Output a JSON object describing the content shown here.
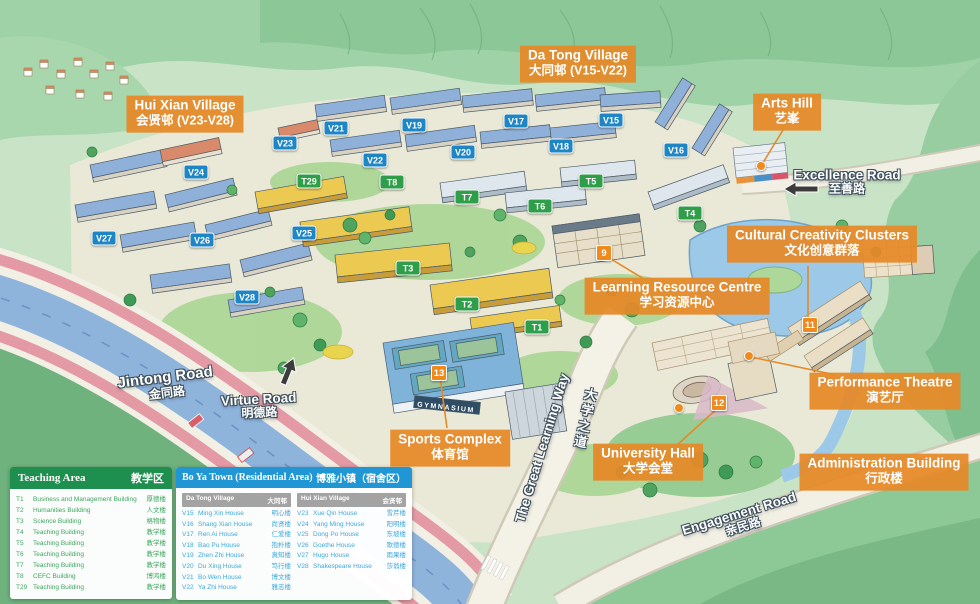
{
  "colors": {
    "label_orange": "#e68927",
    "marker_blue": "#1f86c5",
    "marker_green": "#2f9e49",
    "marker_orange": "#f08a1c",
    "teaching_header": "#1e8f4e",
    "teaching_text": "#3fa45f",
    "boya_header": "#2097d4",
    "boya_text": "#3fa8dc",
    "subheader_gray": "#a3a3a3",
    "connector": "#e68927"
  },
  "map": {
    "area_labels": [
      {
        "id": "hui-xian-village",
        "en": "Hui Xian Village",
        "cn": "会贤邨 (V23-V28)",
        "x": 185,
        "y": 114
      },
      {
        "id": "da-tong-village",
        "en": "Da Tong Village",
        "cn": "大同邨 (V15-V22)",
        "x": 578,
        "y": 64
      },
      {
        "id": "arts-hill",
        "en": "Arts Hill",
        "cn": "艺峯",
        "x": 787,
        "y": 112
      },
      {
        "id": "cultural-creativity-clusters",
        "en": "Cultural Creativity Clusters",
        "cn": "文化创意群落",
        "x": 822,
        "y": 244
      },
      {
        "id": "learning-resource-centre",
        "en": "Learning Resource Centre",
        "cn": "学习资源中心",
        "x": 677,
        "y": 296
      },
      {
        "id": "performance-theatre",
        "en": "Performance Theatre",
        "cn": "演艺厅",
        "x": 885,
        "y": 391
      },
      {
        "id": "administration-building",
        "en": "Administration Building",
        "cn": "行政楼",
        "x": 884,
        "y": 472
      },
      {
        "id": "sports-complex",
        "en": "Sports Complex",
        "cn": "体育馆",
        "x": 450,
        "y": 448
      },
      {
        "id": "university-hall",
        "en": "University Hall",
        "cn": "大学会堂",
        "x": 648,
        "y": 462
      }
    ],
    "road_labels": [
      {
        "id": "excellence-road",
        "en": "Excellence Road",
        "cn": "至善路",
        "x": 847,
        "y": 182,
        "rot": 0,
        "big": false
      },
      {
        "id": "jintong-road",
        "en": "Jintong Road",
        "cn": "金同路",
        "x": 166,
        "y": 385,
        "rot": -7,
        "big": true
      },
      {
        "id": "virtue-road",
        "en": "Virtue Road",
        "cn": "明德路",
        "x": 259,
        "y": 406,
        "rot": -3,
        "big": false
      },
      {
        "id": "engagement-road",
        "en": "Engagement Road",
        "cn": "亲民路",
        "x": 741,
        "y": 520,
        "rot": -17,
        "big": false
      },
      {
        "id": "great-learning-way",
        "en": "The Great Learning Way",
        "cn": "大学之道",
        "x": 542,
        "y": 448,
        "rot": -73,
        "big": false,
        "cn_x": 575,
        "cn_y": 442,
        "cn_rot": 12
      }
    ],
    "markers": [
      {
        "label": "V21",
        "type": "blue",
        "x": 336,
        "y": 128
      },
      {
        "label": "V19",
        "type": "blue",
        "x": 414,
        "y": 125
      },
      {
        "label": "V17",
        "type": "blue",
        "x": 516,
        "y": 121
      },
      {
        "label": "V15",
        "type": "blue",
        "x": 611,
        "y": 120
      },
      {
        "label": "V18",
        "type": "blue",
        "x": 561,
        "y": 146
      },
      {
        "label": "V16",
        "type": "blue",
        "x": 676,
        "y": 150
      },
      {
        "label": "V22",
        "type": "blue",
        "x": 375,
        "y": 160
      },
      {
        "label": "V20",
        "type": "blue",
        "x": 463,
        "y": 152
      },
      {
        "label": "V23",
        "type": "blue",
        "x": 285,
        "y": 143
      },
      {
        "label": "V24",
        "type": "blue",
        "x": 196,
        "y": 172
      },
      {
        "label": "V25",
        "type": "blue",
        "x": 304,
        "y": 233
      },
      {
        "label": "V26",
        "type": "blue",
        "x": 202,
        "y": 240
      },
      {
        "label": "V27",
        "type": "blue",
        "x": 104,
        "y": 238
      },
      {
        "label": "V28",
        "type": "blue",
        "x": 247,
        "y": 297
      },
      {
        "label": "T29",
        "type": "green",
        "x": 309,
        "y": 181
      },
      {
        "label": "T8",
        "type": "green",
        "x": 392,
        "y": 182
      },
      {
        "label": "T7",
        "type": "green",
        "x": 467,
        "y": 197
      },
      {
        "label": "T6",
        "type": "green",
        "x": 540,
        "y": 206
      },
      {
        "label": "T5",
        "type": "green",
        "x": 591,
        "y": 181
      },
      {
        "label": "T4",
        "type": "green",
        "x": 690,
        "y": 213
      },
      {
        "label": "T3",
        "type": "green",
        "x": 408,
        "y": 268
      },
      {
        "label": "T2",
        "type": "green",
        "x": 467,
        "y": 304
      },
      {
        "label": "T1",
        "type": "green",
        "x": 537,
        "y": 327
      },
      {
        "label": "9",
        "type": "orange",
        "x": 604,
        "y": 253
      },
      {
        "label": "11",
        "type": "orange",
        "x": 810,
        "y": 325
      },
      {
        "label": "12",
        "type": "orange",
        "x": 719,
        "y": 403
      },
      {
        "label": "13",
        "type": "orange",
        "x": 439,
        "y": 373
      },
      {
        "label": "",
        "type": "dot",
        "x": 761,
        "y": 166
      },
      {
        "label": "",
        "type": "dot",
        "x": 749,
        "y": 356
      },
      {
        "label": "",
        "type": "dot",
        "x": 679,
        "y": 408
      }
    ],
    "connectors": [
      [
        761,
        166,
        783,
        130
      ],
      [
        606,
        256,
        644,
        279
      ],
      [
        808,
        266,
        808,
        317
      ],
      [
        751,
        357,
        836,
        375
      ],
      [
        719,
        407,
        676,
        446
      ],
      [
        440,
        377,
        447,
        428
      ]
    ],
    "building_texts": [
      {
        "id": "gymnasium",
        "text": "GYMNASIUM",
        "x": 446,
        "y": 408,
        "rot": 6
      }
    ]
  },
  "legend_teaching": {
    "title_en": "Teaching Area",
    "title_cn": "教学区",
    "rows": [
      [
        "T1",
        "Business and Management Building",
        "厚德楼"
      ],
      [
        "T2",
        "Humanities Building",
        "人文楼"
      ],
      [
        "T3",
        "Science Building",
        "格物楼"
      ],
      [
        "T4",
        "Teaching Building",
        "教学楼"
      ],
      [
        "T5",
        "Teaching Building",
        "教学楼"
      ],
      [
        "T6",
        "Teaching Building",
        "教学楼"
      ],
      [
        "T7",
        "Teaching Building",
        "教学楼"
      ],
      [
        "T8",
        "CEFC Building",
        "博鸿楼"
      ],
      [
        "T29",
        "Teaching Building",
        "教学楼"
      ]
    ]
  },
  "legend_boya": {
    "title_en": "Bo Ya Town (Residential Area)",
    "title_cn": "博雅小镇（宿舍区）",
    "columns": [
      {
        "header_en": "Da Tong Village",
        "header_cn": "大同邨",
        "rows": [
          [
            "V15",
            "Ming Xin House",
            "明心楼"
          ],
          [
            "V16",
            "Shang Xian House",
            "尚贤楼"
          ],
          [
            "V17",
            "Ren Ai House",
            "仁爱楼"
          ],
          [
            "V18",
            "Bao Pu House",
            "抱朴楼"
          ],
          [
            "V19",
            "Zhen Zhi House",
            "真知楼"
          ],
          [
            "V20",
            "Du Xing House",
            "笃行楼"
          ],
          [
            "V21",
            "Bo Wen House",
            "博文楼"
          ],
          [
            "V22",
            "Ya Zhi House",
            "雅志楼"
          ]
        ]
      },
      {
        "header_en": "Hui Xian Village",
        "header_cn": "会贤邨",
        "rows": [
          [
            "V23",
            "Xue Qin House",
            "雪芹楼"
          ],
          [
            "V24",
            "Yang Ming House",
            "阳明楼"
          ],
          [
            "V25",
            "Dong Po House",
            "东坡楼"
          ],
          [
            "V26",
            "Goethe House",
            "歌德楼"
          ],
          [
            "V27",
            "Hugo House",
            "雨果楼"
          ],
          [
            "V28",
            "Shakespeare House",
            "莎翁楼"
          ]
        ]
      }
    ]
  }
}
